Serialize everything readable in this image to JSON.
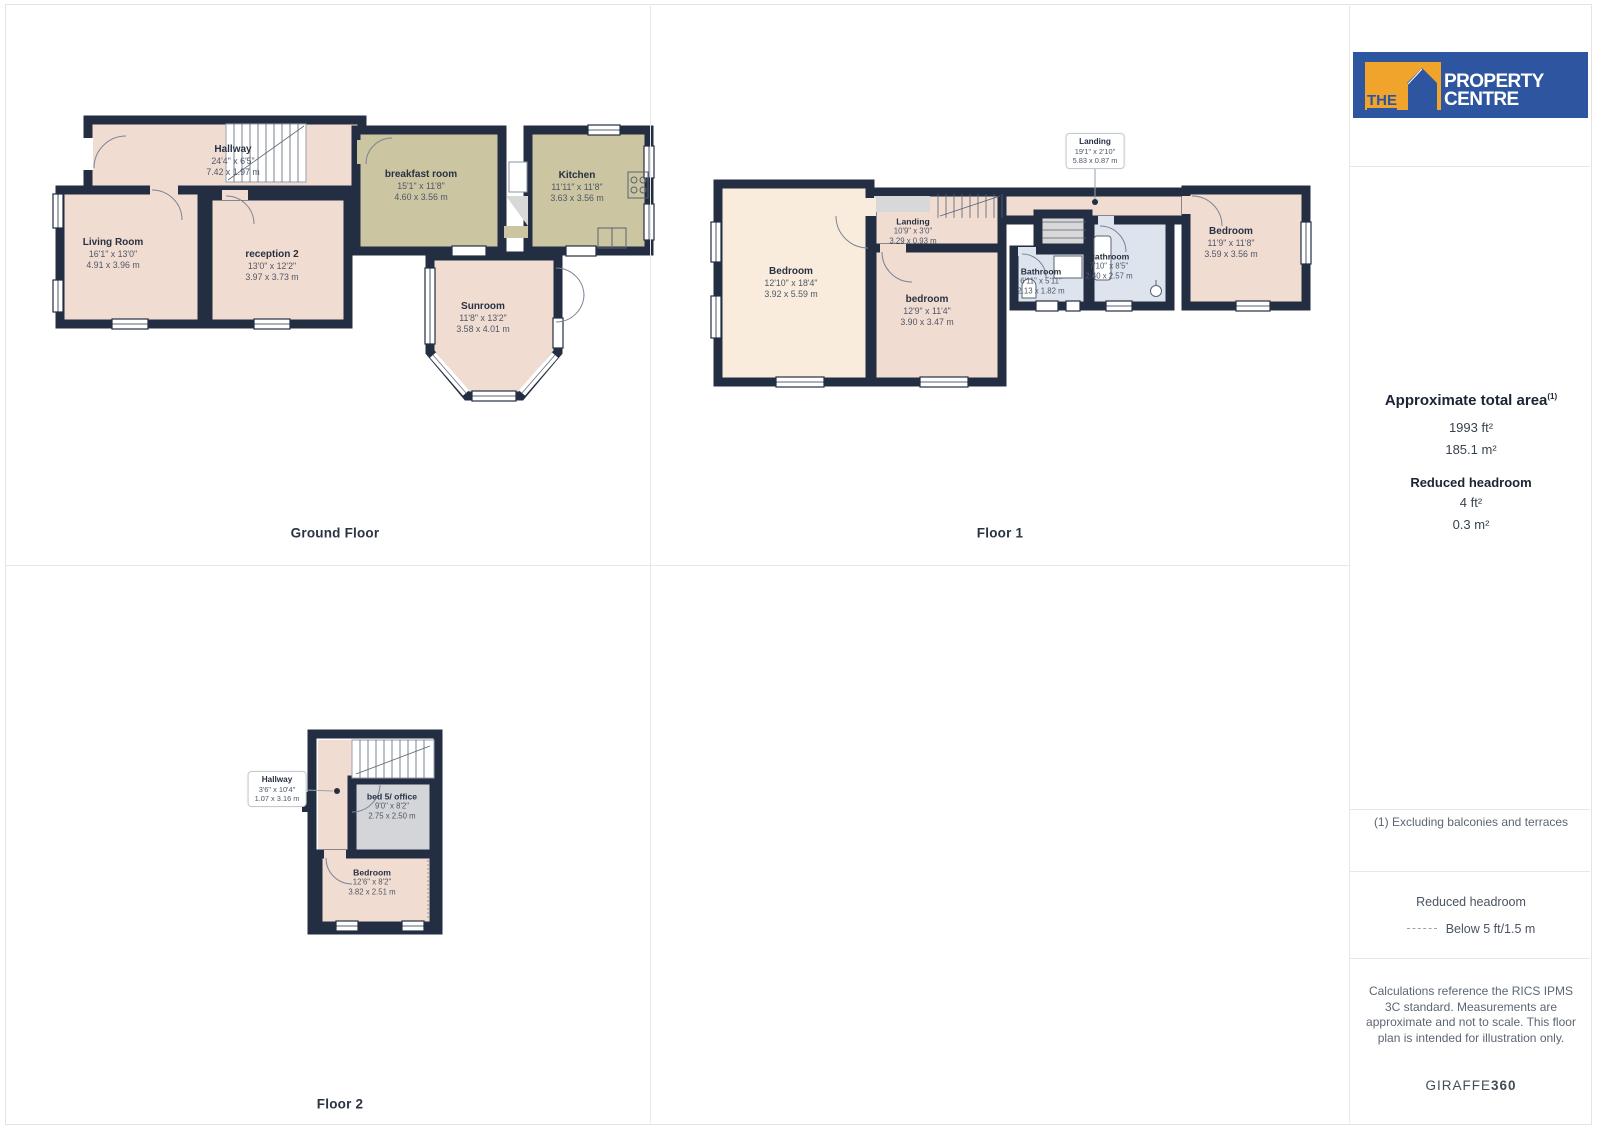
{
  "floors": {
    "ground": {
      "title": "Ground Floor",
      "rooms": {
        "hallway": {
          "name": "Hallway",
          "imperial": "24'4\" x 6'5\"",
          "metric": "7.42 x 1.97 m"
        },
        "living": {
          "name": "Living Room",
          "imperial": "16'1\" x 13'0\"",
          "metric": "4.91 x 3.96 m"
        },
        "reception": {
          "name": "reception 2",
          "imperial": "13'0\" x 12'2\"",
          "metric": "3.97 x 3.73 m"
        },
        "breakfast": {
          "name": "breakfast room",
          "imperial": "15'1\" x 11'8\"",
          "metric": "4.60 x 3.56 m"
        },
        "kitchen": {
          "name": "Kitchen",
          "imperial": "11'11\" x 11'8\"",
          "metric": "3.63 x 3.56 m"
        },
        "sunroom": {
          "name": "Sunroom",
          "imperial": "11'8\" x 13'2\"",
          "metric": "3.58 x 4.01 m"
        }
      }
    },
    "floor1": {
      "title": "Floor 1",
      "rooms": {
        "landing_callout": {
          "name": "Landing",
          "imperial": "19'1\" x 2'10\"",
          "metric": "5.83 x 0.87 m"
        },
        "bedroom_left": {
          "name": "Bedroom",
          "imperial": "12'10\" x 18'4\"",
          "metric": "3.92 x 5.59 m"
        },
        "landing": {
          "name": "Landing",
          "imperial": "10'9\" x 3'0\"",
          "metric": "3.29 x 0.93 m"
        },
        "bedroom_mid": {
          "name": "bedroom",
          "imperial": "12'9\" x 11'4\"",
          "metric": "3.90 x 3.47 m"
        },
        "bathroom_small": {
          "name": "Bathroom",
          "imperial": "6'11\" x 5'11\"",
          "metric": "2.13 x 1.82 m"
        },
        "bathroom_large": {
          "name": "Bathroom",
          "imperial": "7'10\" x 8'5\"",
          "metric": "2.40 x 2.57 m"
        },
        "bedroom_right": {
          "name": "Bedroom",
          "imperial": "11'9\" x 11'8\"",
          "metric": "3.59 x 3.56 m"
        }
      }
    },
    "floor2": {
      "title": "Floor 2",
      "rooms": {
        "hallway_callout": {
          "name": "Hallway",
          "imperial": "3'6\" x 10'4\"",
          "metric": "1.07 x 3.16 m"
        },
        "bed5_office": {
          "name": "bed 5/ office",
          "imperial": "9'0\" x 8'2\"",
          "metric": "2.75 x 2.50 m"
        },
        "bedroom": {
          "name": "Bedroom",
          "imperial": "12'6\" x 8'2\"",
          "metric": "3.82 x 2.51 m"
        }
      }
    }
  },
  "branding": {
    "logo_the": "THE",
    "logo_name": "PROPERTY CENTRE",
    "logo_blue": "#2d55a0",
    "logo_orange": "#f0a42c",
    "giraffe_normal": "GIRAFFE",
    "giraffe_bold": "360"
  },
  "sidebar": {
    "area_title": "Approximate total area",
    "area_footnote_marker": "(1)",
    "area_ft": "1993 ft²",
    "area_m": "185.1 m²",
    "headroom_title": "Reduced headroom",
    "headroom_ft": "4 ft²",
    "headroom_m": "0.3 m²",
    "footnote": "(1) Excluding balconies and terraces",
    "legend_title": "Reduced headroom",
    "legend_value": "Below 5 ft/1.5 m",
    "disclaimer": "Calculations reference the RICS IPMS 3C standard. Measurements are approximate and not to scale. This floor plan is intended for illustration only."
  },
  "palette": {
    "wall": "#232e42",
    "room_pink": "#f1dcd2",
    "room_cream": "#faecdd",
    "room_olive": "#cbc5a2",
    "room_blue": "#dde4ee",
    "room_gray": "#d3d5d9",
    "stair_gray": "#d8d8d8"
  }
}
